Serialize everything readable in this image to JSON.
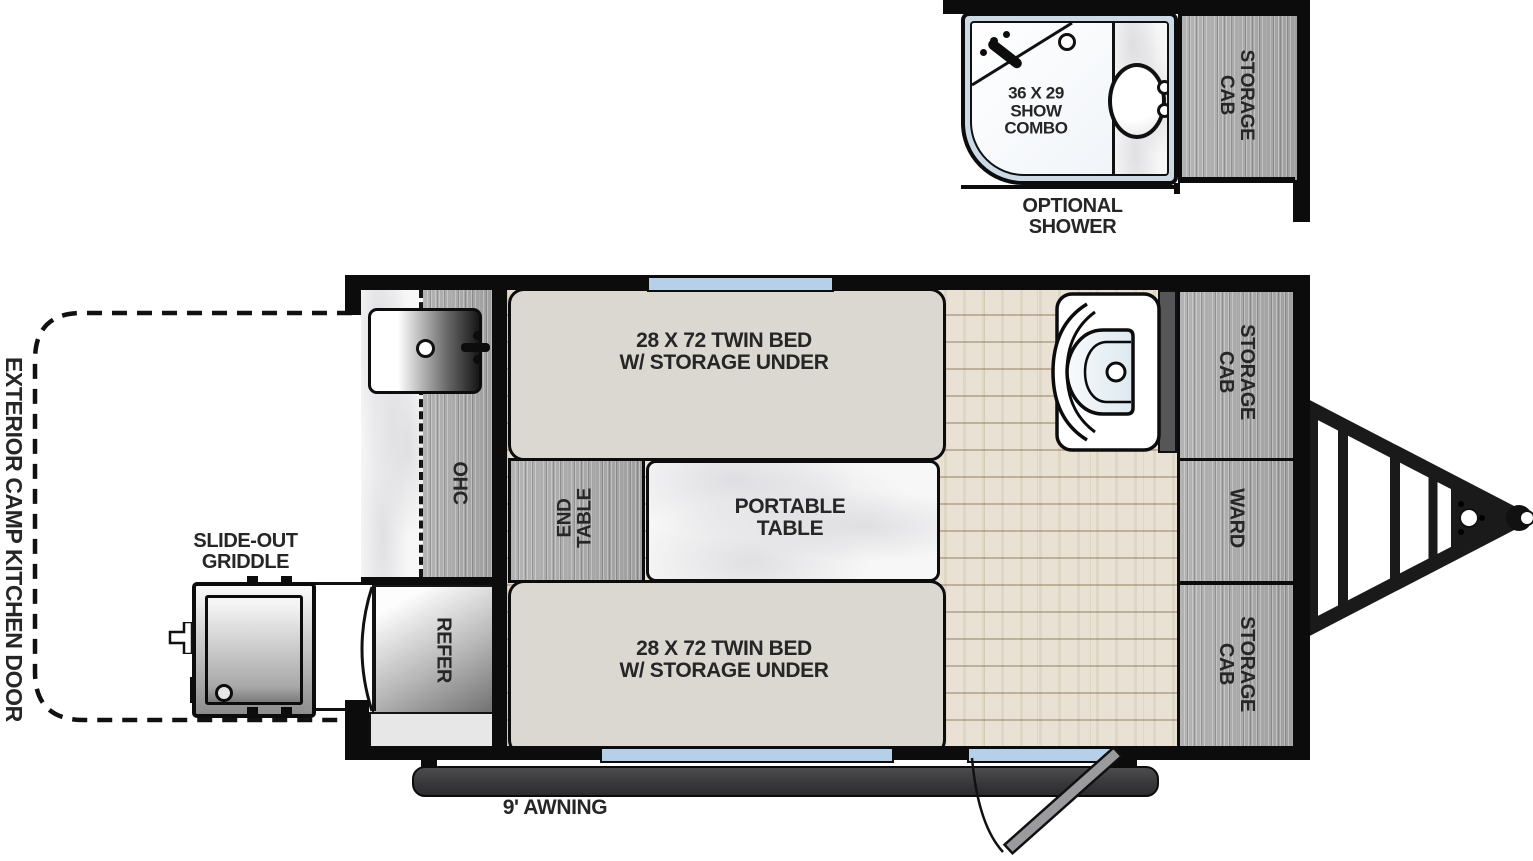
{
  "colors": {
    "wall": "#0c0c0c",
    "cabinet_wood": "#ababab",
    "floor_wood": "#e8e1d3",
    "bed_fill": "#dad8d0",
    "window_glass": "#b5d0e8",
    "awning": "#3e3e40",
    "marble": "#f6f6f6",
    "shower_rim": "#ccdae6"
  },
  "inset_bathroom": {
    "shower_size": {
      "line1": "36 X 29",
      "line2": "SHOW",
      "line3": "COMBO"
    },
    "storage_cab": {
      "line1": "STORAGE",
      "line2": "CAB"
    },
    "caption": {
      "line1": "OPTIONAL",
      "line2": "SHOWER"
    }
  },
  "kitchen": {
    "overhead_cabinet": "OHC",
    "refrigerator": "REFER"
  },
  "bedroom": {
    "twin_bed_top": {
      "line1": "28 X 72 TWIN BED",
      "line2": "W/ STORAGE UNDER"
    },
    "twin_bed_bottom": {
      "line1": "28 X 72 TWIN BED",
      "line2": "W/ STORAGE UNDER"
    },
    "end_table": {
      "line1": "END",
      "line2": "TABLE"
    },
    "portable_table": {
      "line1": "PORTABLE",
      "line2": "TABLE"
    }
  },
  "storage": {
    "storage_cab_top": {
      "line1": "STORAGE",
      "line2": "CAB"
    },
    "wardrobe": "WARD",
    "storage_cab_bottom": {
      "line1": "STORAGE",
      "line2": "CAB"
    }
  },
  "exterior": {
    "camp_kitchen_door": "EXTERIOR CAMP KITCHEN DOOR",
    "griddle": {
      "line1": "SLIDE-OUT",
      "line2": "GRIDDLE"
    },
    "awning": "9' AWNING"
  }
}
